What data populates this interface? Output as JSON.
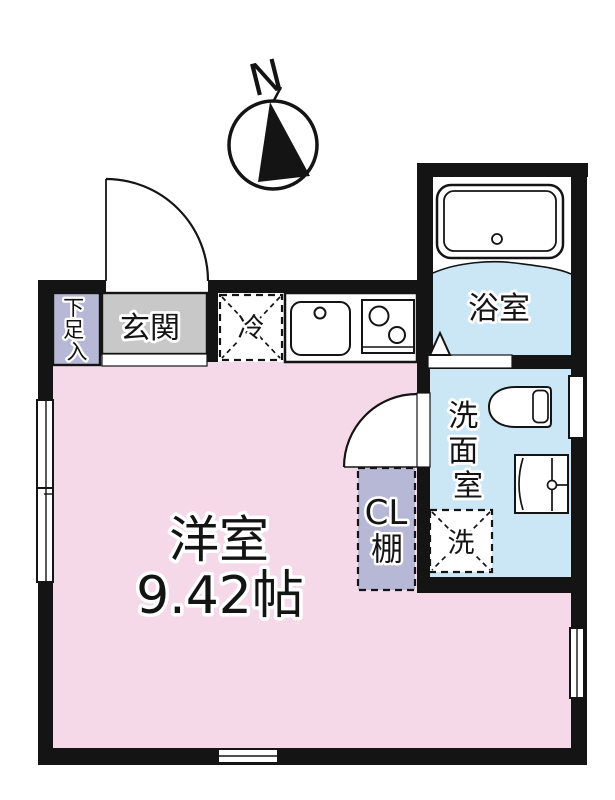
{
  "compass": {
    "north_label": "N"
  },
  "rooms": {
    "main_room": {
      "name": "洋室",
      "size": "9.42帖"
    },
    "entrance": {
      "name": "玄関"
    },
    "shoe_box": {
      "name": "下足入",
      "chars": [
        "下",
        "足",
        "入"
      ]
    },
    "bathroom": {
      "name": "浴室"
    },
    "washroom": {
      "name": "洗面室",
      "chars": [
        "洗",
        "面",
        "室"
      ]
    },
    "closet": {
      "line1": "CL",
      "line2": "棚"
    }
  },
  "fixtures": {
    "refrigerator": {
      "label": "冷"
    },
    "washing_machine": {
      "label": "洗"
    }
  },
  "colors": {
    "background": "#ffffff",
    "wall": "#141414",
    "main_room_pink": "#f5d9e8",
    "wet_area_blue": "#cbe6f4",
    "closet_lavender": "#b7b7d6",
    "entrance_gray": "#c8c8c8"
  }
}
